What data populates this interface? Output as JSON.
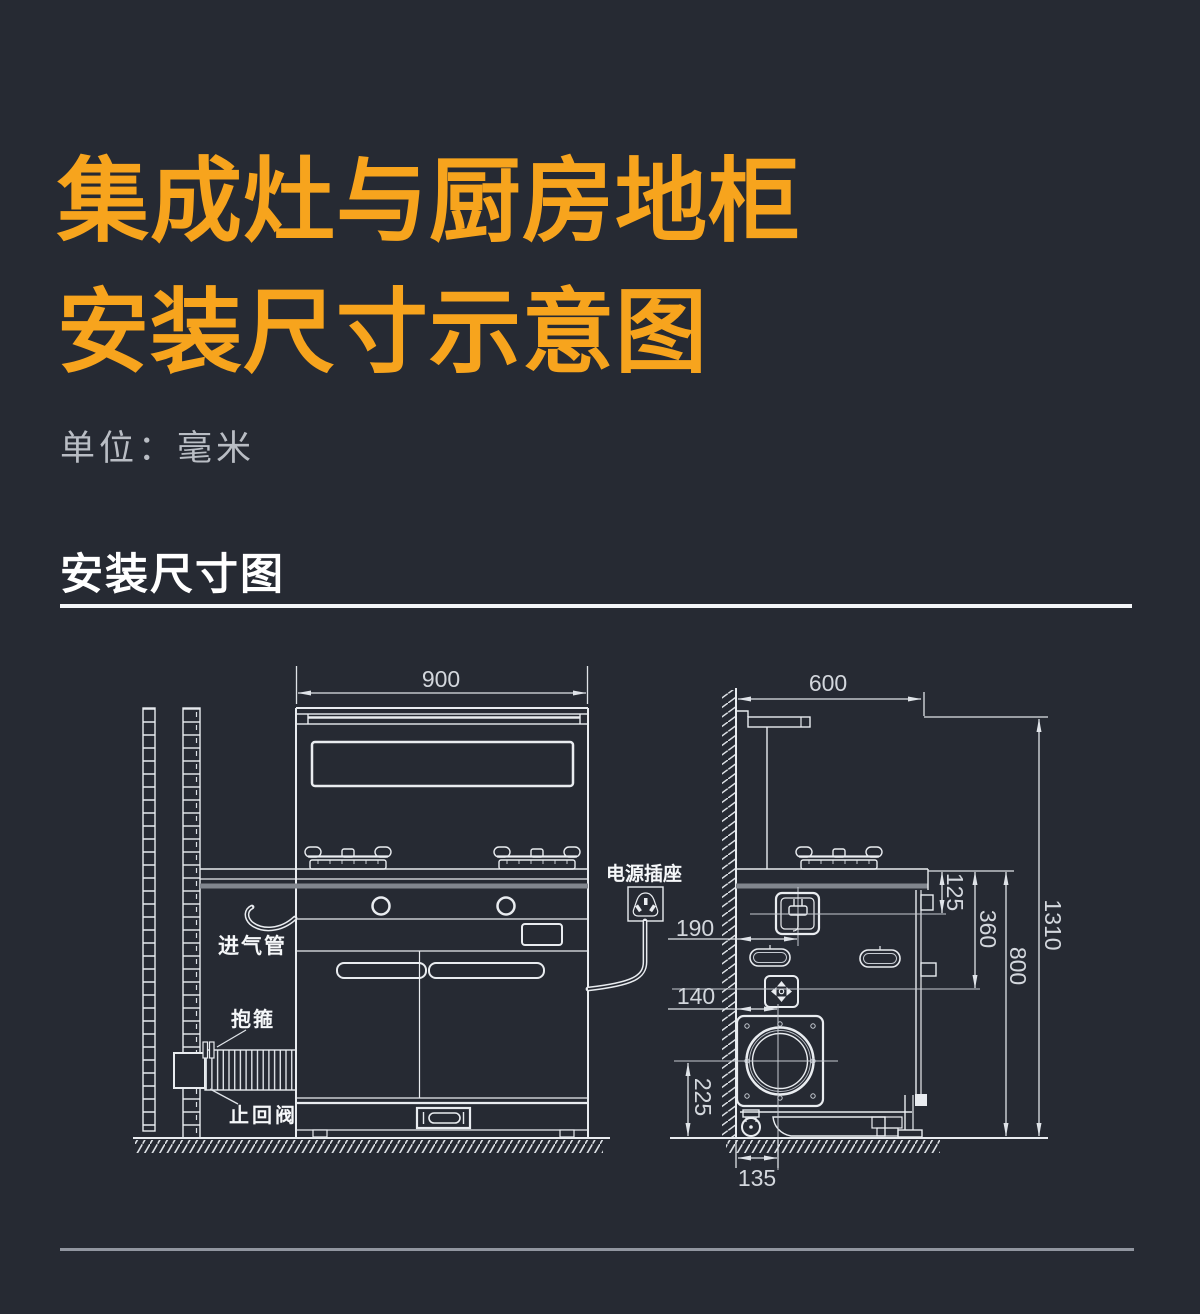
{
  "header": {
    "title_line1": "集成灶与厨房地柜",
    "title_line2": "安装尺寸示意图",
    "unit_note": "单位：毫米",
    "section_title": "安装尺寸图"
  },
  "colors": {
    "background": "#262a33",
    "accent_orange": "#f7a41d",
    "drawing_line": "#e9ecf0",
    "dim_text": "#d3d7dd"
  },
  "diagram": {
    "front_view": {
      "width_mm": "900",
      "gas_inlet_pipe_label": "进气管",
      "clamp_label": "抱箍",
      "check_valve_label": "止回阀",
      "power_socket_label": "电源插座"
    },
    "side_view": {
      "depth_mm": "600",
      "socket_drop_from_counter_mm": "125",
      "gas_drop_from_counter_mm": "360",
      "overall_height_mm": "1310",
      "counter_height_mm": "800",
      "socket_center_from_wall_mm": "190",
      "gas_center_from_wall_mm": "140",
      "flue_center_above_floor_mm": "225",
      "flue_center_from_wall_mm": "135"
    }
  }
}
